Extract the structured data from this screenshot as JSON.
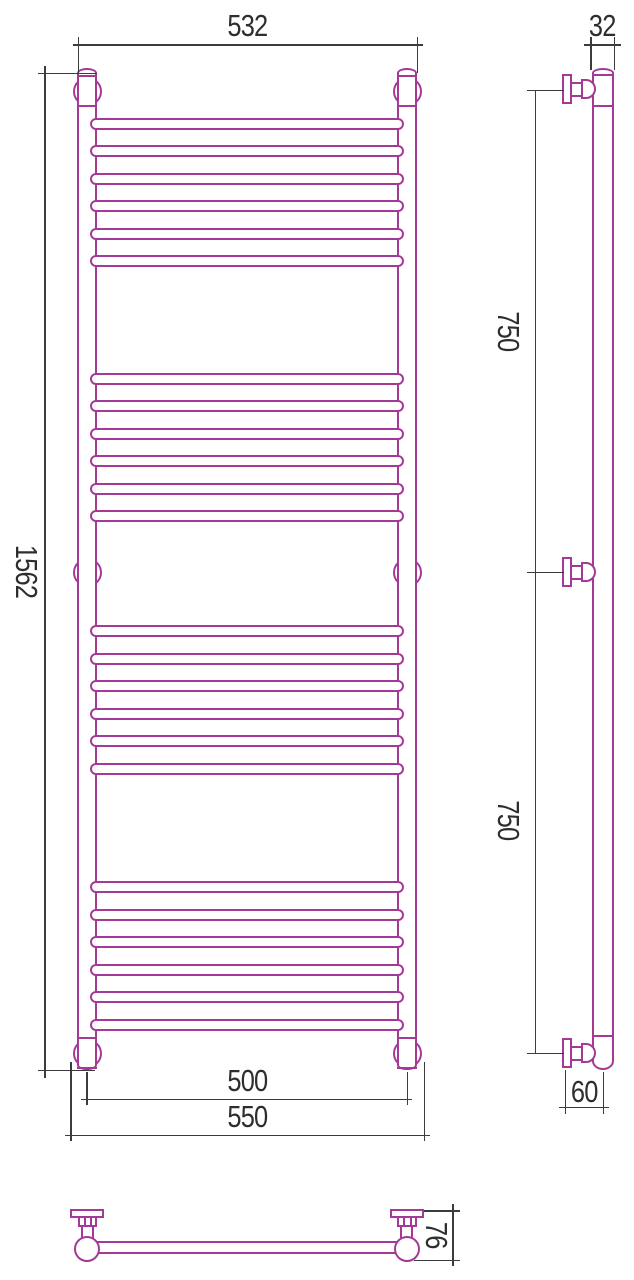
{
  "colors": {
    "tube_stroke": "#a53a96",
    "dimension_line": "#3c3c3c",
    "label_text": "#2e2e2e"
  },
  "labels": {
    "front_top_width": "532",
    "side_tube_diameter": "32",
    "front_overall_height": "1562",
    "side_upper_bracket_spacing": "750",
    "side_lower_bracket_spacing": "750",
    "front_bottom_bracket_axis_width": "500",
    "front_bottom_overall_width": "550",
    "side_wall_to_axis_offset": "60",
    "plan_wall_to_front_depth": "76"
  },
  "front_view": {
    "tubes": {
      "left_x": 77,
      "right_x": 397,
      "width": 20,
      "top": 68,
      "height": 1002
    },
    "rung": {
      "x": 90,
      "width": 314,
      "height": 12
    },
    "rung_groups": [
      {
        "first_top": 118,
        "count": 6,
        "pitch": 27.4
      },
      {
        "first_top": 373,
        "count": 6,
        "pitch": 27.4
      },
      {
        "first_top": 625,
        "count": 6,
        "pitch": 27.5
      },
      {
        "first_top": 881,
        "count": 6,
        "pitch": 27.5
      }
    ],
    "bracket_radius": 14.5,
    "brackets": [
      {
        "cx": 87,
        "cy": 91,
        "collar": true
      },
      {
        "cx": 407,
        "cy": 91,
        "collar": true
      },
      {
        "cx": 87,
        "cy": 572,
        "collar": false
      },
      {
        "cx": 407,
        "cy": 572,
        "collar": false
      },
      {
        "cx": 87,
        "cy": 1053,
        "collar": true
      },
      {
        "cx": 407,
        "cy": 1053,
        "collar": true
      }
    ]
  }
}
